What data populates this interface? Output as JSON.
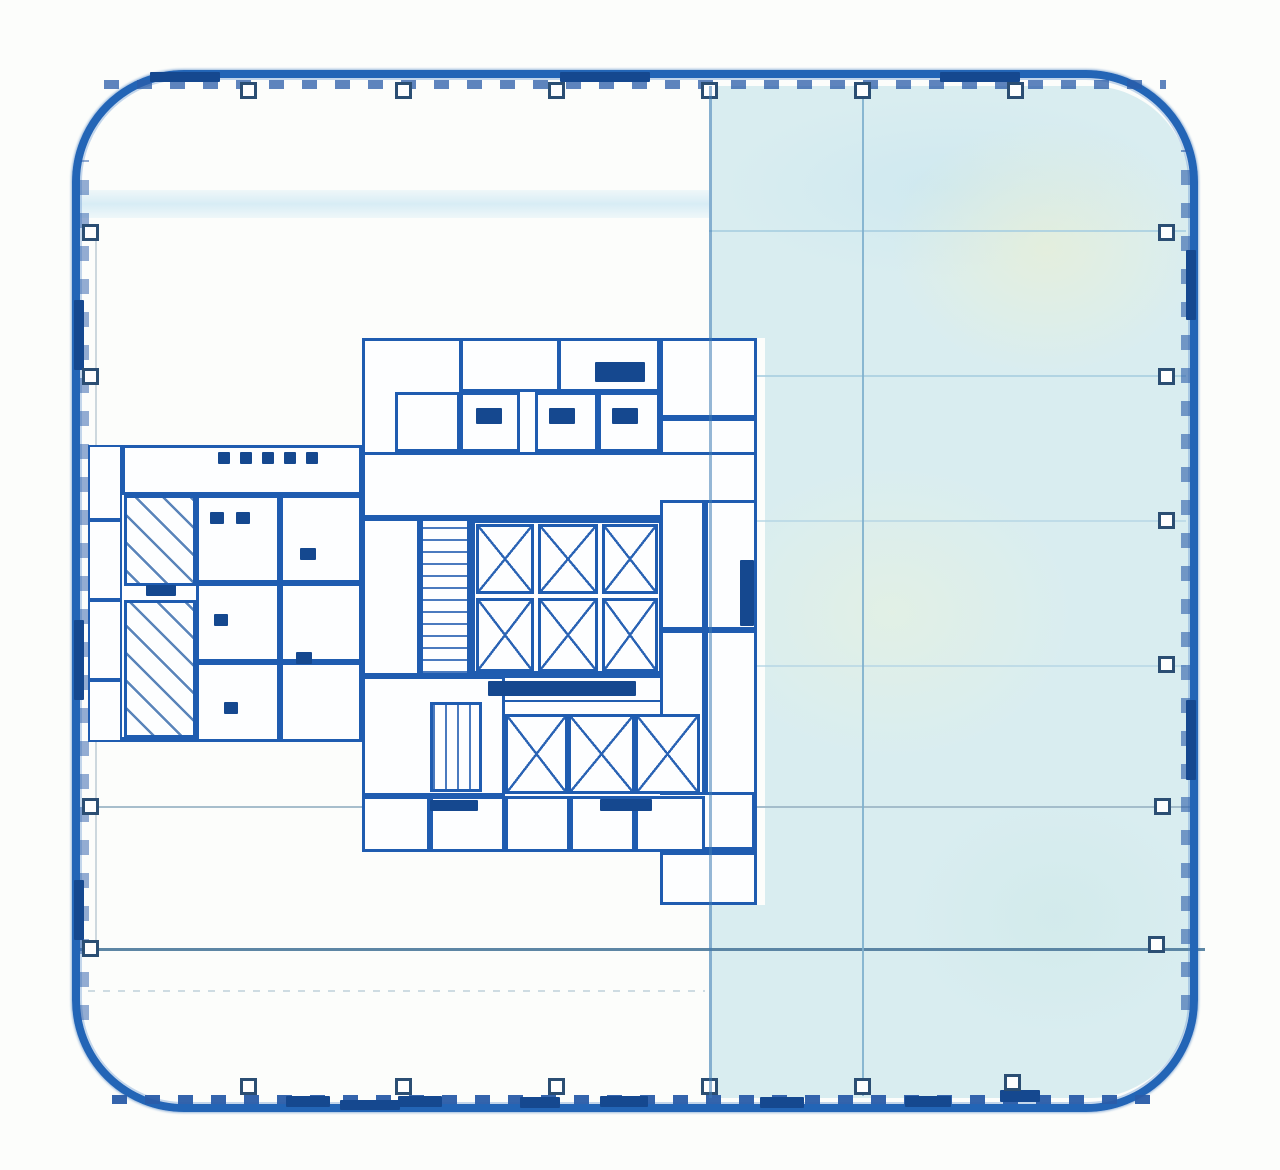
{
  "title": "scanned-building-floor-plan",
  "plan": {
    "width": 1280,
    "height": 1170,
    "colors": {
      "paper": "#fcfdfb",
      "outer_wall": "#2365b6",
      "wall_dark": "#17498f",
      "core_line": "#1f5cb0",
      "room_fill": "#fdfeff",
      "shaded_fill": "#d9edf0",
      "grid_light": "#a9cfe1",
      "grid_medium": "#7fb0cd",
      "grid_dark": "#54809f",
      "column_marker": "#2b4e73",
      "accent": "#15488f",
      "hatch_line": "#3d6fae"
    },
    "band": [
      76,
      190,
      1118,
      28
    ],
    "outer_wall": {
      "x": 72,
      "y": 70,
      "w": 1126,
      "h": 1042,
      "radius": 112,
      "thickness": 8
    },
    "shaded_area": [
      709,
      86,
      481,
      1012
    ],
    "core_notch": [
      705,
      338,
      60,
      567
    ],
    "grid_h": [
      [
        709,
        1186,
        230,
        "#a9cfe1",
        2,
        0.85,
        "solid"
      ],
      [
        709,
        1186,
        375,
        "#a9cfe1",
        2,
        0.85,
        "solid"
      ],
      [
        709,
        1186,
        520,
        "#b3d4e4",
        1.5,
        0.7,
        "solid"
      ],
      [
        709,
        1186,
        665,
        "#b3d4e4",
        1.5,
        0.7,
        "solid"
      ],
      [
        84,
        1192,
        806,
        "#9db7c7",
        2,
        0.9,
        "solid"
      ],
      [
        78,
        1205,
        948,
        "#54809f",
        2.5,
        0.95,
        "solid"
      ],
      [
        88,
        705,
        990,
        "#c3d3dc",
        1.5,
        0.8,
        "dashed"
      ]
    ],
    "grid_v": [
      [
        862,
        88,
        1096,
        "#7fb0cd",
        2,
        0.9
      ],
      [
        95,
        225,
        950,
        "#b9c8d2",
        1.5,
        0.7
      ]
    ],
    "grid_v_over": [
      [
        709,
        86,
        1098,
        "#3f7cb5",
        2.5,
        0.55
      ]
    ],
    "wall_ticks": [
      [
        104,
        80,
        1062,
        9,
        "h",
        0.75
      ],
      [
        112,
        1095,
        1056,
        9,
        "h",
        0.95
      ],
      [
        80,
        160,
        9,
        860,
        "v",
        0.5
      ],
      [
        1181,
        150,
        9,
        860,
        "v",
        0.6
      ]
    ],
    "column_markers": {
      "size": 17,
      "top": [
        [
          248,
          90
        ],
        [
          403,
          90
        ],
        [
          556,
          90
        ],
        [
          709,
          90
        ],
        [
          862,
          90
        ],
        [
          1015,
          90
        ]
      ],
      "bottom": [
        [
          248,
          1086
        ],
        [
          403,
          1086
        ],
        [
          556,
          1086
        ],
        [
          709,
          1086
        ],
        [
          862,
          1086
        ],
        [
          1012,
          1082
        ]
      ],
      "left": [
        [
          90,
          232
        ],
        [
          90,
          376
        ],
        [
          90,
          806
        ],
        [
          90,
          948
        ]
      ],
      "right": [
        [
          1166,
          232
        ],
        [
          1166,
          376
        ],
        [
          1166,
          520
        ],
        [
          1166,
          664
        ],
        [
          1162,
          806
        ],
        [
          1156,
          944
        ]
      ]
    },
    "rooms": [
      [
        362,
        338,
        395,
        514,
        5
      ],
      [
        362,
        338,
        100,
        118,
        3
      ],
      [
        460,
        338,
        100,
        54,
        3
      ],
      [
        558,
        338,
        102,
        54,
        3
      ],
      [
        660,
        338,
        97,
        80,
        3
      ],
      [
        395,
        392,
        65,
        60,
        3
      ],
      [
        460,
        392,
        60,
        60,
        3
      ],
      [
        535,
        392,
        63,
        60,
        3
      ],
      [
        598,
        392,
        62,
        60,
        3
      ],
      [
        660,
        418,
        97,
        84,
        3
      ],
      [
        362,
        452,
        395,
        66,
        3
      ],
      [
        362,
        518,
        58,
        158,
        3
      ],
      [
        470,
        518,
        194,
        158,
        5
      ],
      [
        470,
        676,
        194,
        26,
        2
      ],
      [
        362,
        676,
        143,
        120,
        3
      ],
      [
        660,
        500,
        45,
        130,
        3
      ],
      [
        705,
        500,
        52,
        130,
        3
      ],
      [
        660,
        630,
        45,
        165,
        3
      ],
      [
        705,
        630,
        52,
        165,
        3
      ],
      [
        362,
        796,
        68,
        56,
        3
      ],
      [
        430,
        796,
        75,
        56,
        3
      ],
      [
        505,
        796,
        65,
        56,
        3
      ],
      [
        570,
        796,
        65,
        56,
        3
      ],
      [
        635,
        796,
        70,
        56,
        3
      ],
      [
        660,
        852,
        97,
        53,
        3
      ],
      [
        88,
        445,
        274,
        297,
        5
      ],
      [
        88,
        445,
        34,
        75,
        2
      ],
      [
        88,
        520,
        34,
        80,
        2
      ],
      [
        88,
        600,
        34,
        80,
        2
      ],
      [
        88,
        680,
        34,
        62,
        2
      ],
      [
        122,
        445,
        240,
        50,
        3
      ],
      [
        196,
        495,
        84,
        88,
        3
      ],
      [
        280,
        495,
        82,
        88,
        3
      ],
      [
        196,
        583,
        84,
        79,
        3
      ],
      [
        280,
        583,
        82,
        79,
        3
      ],
      [
        196,
        662,
        84,
        80,
        3
      ],
      [
        280,
        662,
        82,
        80,
        3
      ]
    ],
    "elevator_cells": [
      [
        476,
        524,
        58,
        70
      ],
      [
        538,
        524,
        60,
        70
      ],
      [
        602,
        524,
        56,
        70
      ],
      [
        476,
        598,
        58,
        74
      ],
      [
        538,
        598,
        60,
        74
      ],
      [
        602,
        598,
        56,
        74
      ],
      [
        505,
        714,
        63,
        80
      ],
      [
        568,
        714,
        67,
        80
      ],
      [
        635,
        714,
        65,
        80
      ]
    ],
    "stairs": [
      [
        420,
        518,
        50,
        158,
        "h"
      ],
      [
        430,
        702,
        52,
        90,
        "v"
      ]
    ],
    "ramp_hatch": [
      124,
      495,
      72,
      243
    ],
    "ramp_landing": [
      124,
      583,
      72,
      20
    ],
    "accents": [
      [
        595,
        362,
        50,
        20
      ],
      [
        488,
        681,
        148,
        15
      ],
      [
        740,
        560,
        14,
        66
      ],
      [
        476,
        408,
        26,
        16
      ],
      [
        549,
        408,
        26,
        16
      ],
      [
        612,
        408,
        26,
        16
      ],
      [
        218,
        452,
        12,
        12
      ],
      [
        240,
        452,
        12,
        12
      ],
      [
        262,
        452,
        12,
        12
      ],
      [
        284,
        452,
        12,
        12
      ],
      [
        306,
        452,
        12,
        12
      ],
      [
        210,
        512,
        14,
        12
      ],
      [
        236,
        512,
        14,
        12
      ],
      [
        300,
        548,
        16,
        12
      ],
      [
        214,
        614,
        14,
        12
      ],
      [
        296,
        652,
        16,
        12
      ],
      [
        224,
        702,
        14,
        12
      ],
      [
        146,
        585,
        30,
        11
      ],
      [
        430,
        800,
        48,
        11
      ],
      [
        600,
        799,
        52,
        12
      ],
      [
        286,
        1096,
        44,
        11
      ],
      [
        398,
        1096,
        44,
        11
      ],
      [
        520,
        1097,
        40,
        11
      ],
      [
        600,
        1096,
        48,
        11
      ],
      [
        760,
        1097,
        44,
        11
      ],
      [
        905,
        1096,
        46,
        11
      ],
      [
        1000,
        1090,
        40,
        12
      ],
      [
        74,
        300,
        10,
        70
      ],
      [
        74,
        620,
        10,
        80
      ],
      [
        74,
        880,
        10,
        60
      ],
      [
        150,
        72,
        70,
        10
      ],
      [
        560,
        72,
        90,
        10
      ],
      [
        940,
        72,
        80,
        10
      ],
      [
        1186,
        250,
        10,
        70
      ],
      [
        1186,
        700,
        10,
        80
      ],
      [
        340,
        1100,
        60,
        10
      ]
    ]
  }
}
